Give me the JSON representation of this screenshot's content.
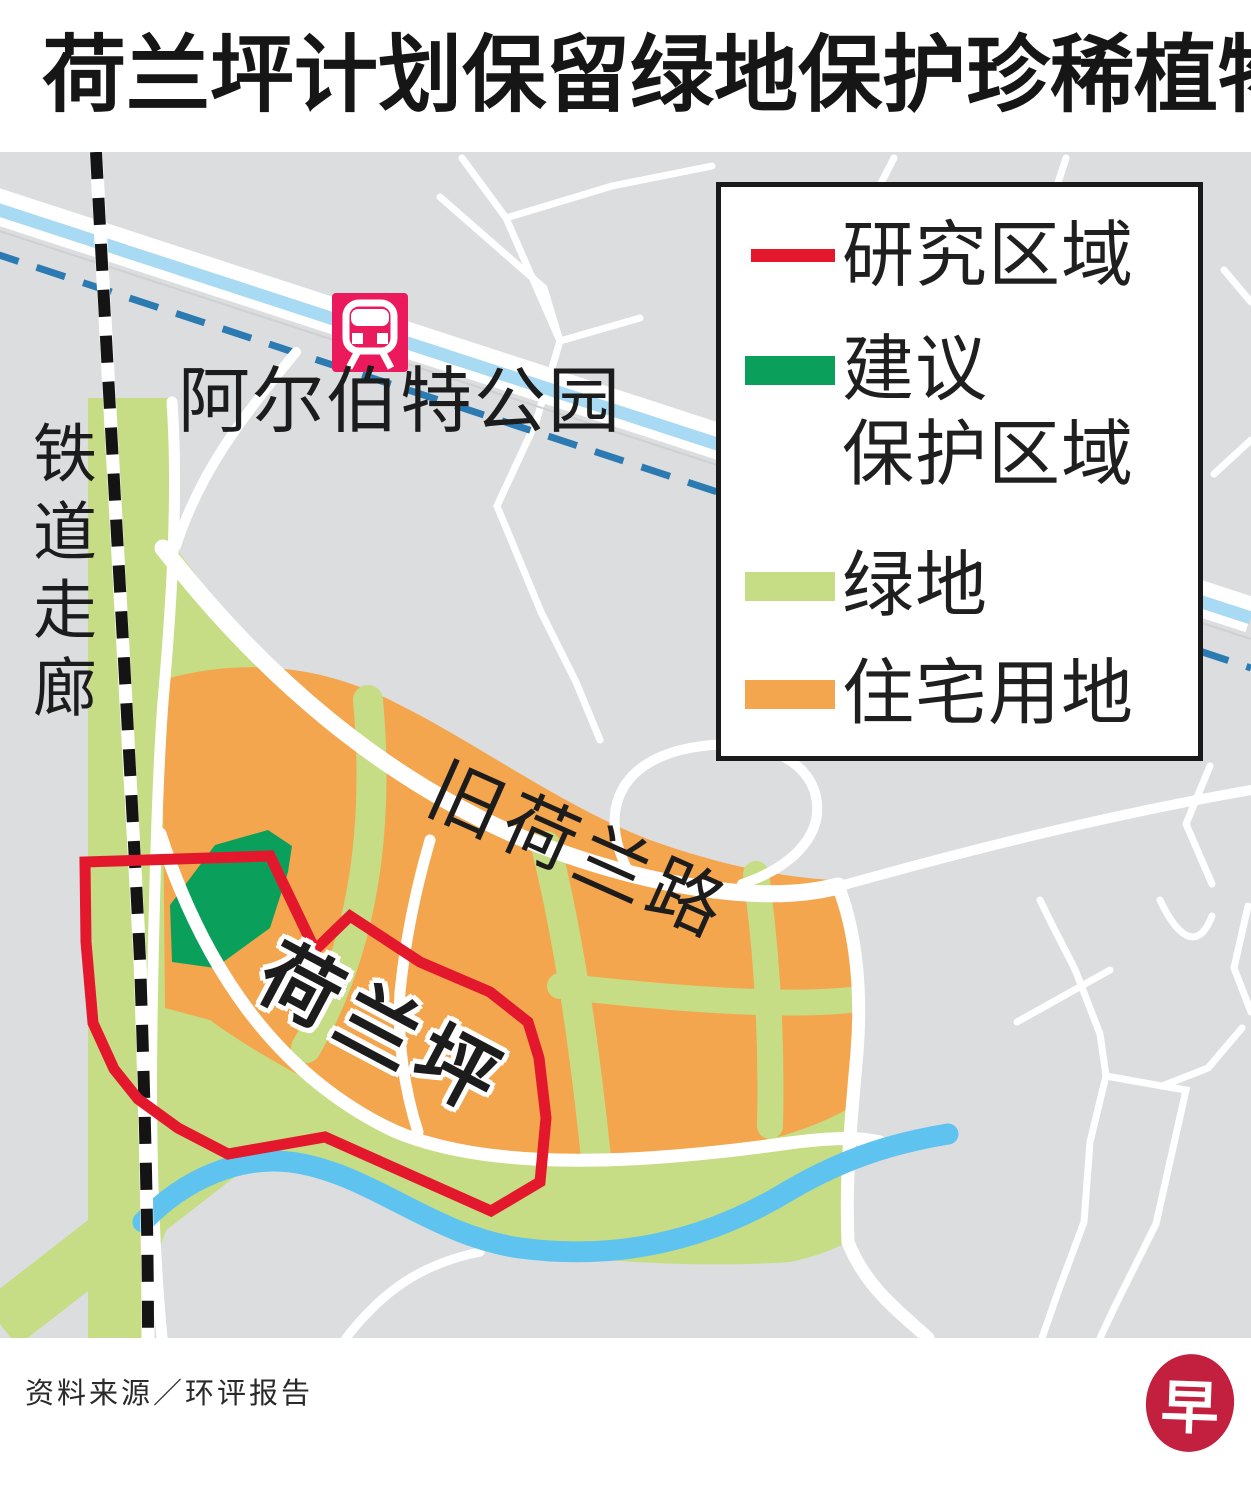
{
  "title": "荷兰坪计划保留绿地保护珍稀植物",
  "legend": {
    "items": [
      {
        "label": "研究区域",
        "swatch": "line",
        "color": "#e4182c"
      },
      {
        "label_line1": "建议",
        "label_line2": "保护区域",
        "swatch": "rect",
        "color": "#0aa05c"
      },
      {
        "label": "绿地",
        "swatch": "rect",
        "color": "#c6dd85"
      },
      {
        "label": "住宅用地",
        "swatch": "rect",
        "color": "#f4a64e"
      }
    ]
  },
  "map": {
    "labels": {
      "station": "阿尔伯特公园",
      "rail_corridor": "铁道走廊",
      "old_holland_road": "旧荷兰路",
      "holland_plain": "荷兰坪"
    },
    "colors": {
      "background_gray": "#dcdddf",
      "road_white": "#ffffff",
      "green_space": "#c6dd85",
      "residential_orange": "#f4a64e",
      "protected_dark_green": "#0aa05c",
      "study_area_red": "#e4182c",
      "canal_blue": "#5fc3ef",
      "waterway_pale_blue": "#a9daf3",
      "mrt_line_dashed_blue": "#2b7ab2",
      "mrt_station_pink": "#ea1a5d"
    }
  },
  "footer": {
    "source": "资料来源／环评报告"
  },
  "logo": {
    "char": "早",
    "color": "#c32040"
  }
}
